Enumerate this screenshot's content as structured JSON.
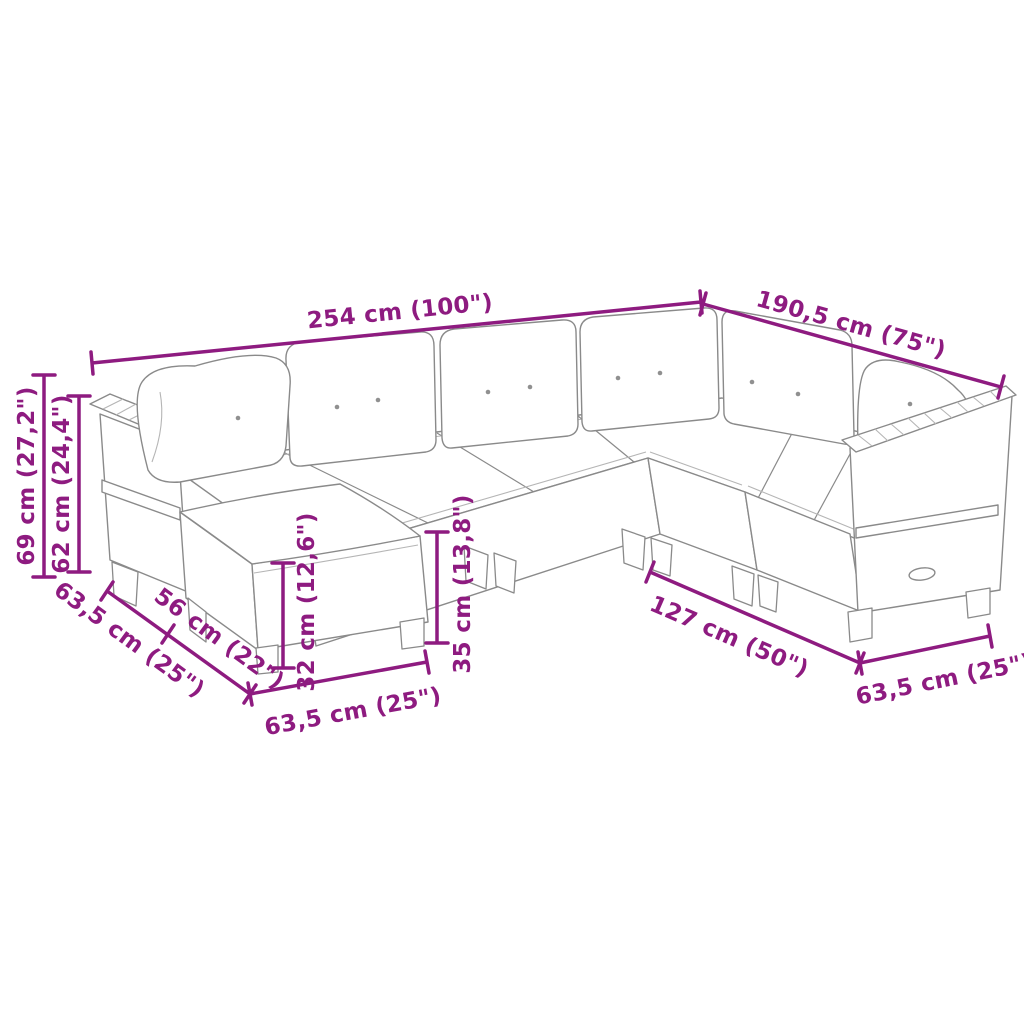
{
  "page": {
    "background": "#ffffff",
    "description_visible_text_only": true
  },
  "colors": {
    "dimension_accent": "#8E1B80",
    "line_art": "#8a8a8a",
    "rattan_texture": "#ababab",
    "cushion_fill": "#ffffff"
  },
  "dimensions": {
    "total_length_top": {
      "label": "254 cm (100\")"
    },
    "total_depth_right": {
      "label": "190,5 cm (75\")"
    },
    "overall_height": {
      "label": "69 cm (27,2\")"
    },
    "armrest_height": {
      "label": "62 cm (24,4\")"
    },
    "module_depth_left": {
      "label": "63,5 cm (25\")"
    },
    "seat_width": {
      "label": "56 cm (22\")"
    },
    "footstool_height": {
      "label": "32 cm (12,6\")"
    },
    "seat_height": {
      "label": "35 cm (13,8\")"
    },
    "footstool_width": {
      "label": "63,5 cm (25\")"
    },
    "right_section_length": {
      "label": "127 cm (50\")"
    },
    "end_module_depth": {
      "label": "63,5 cm (25\")"
    }
  }
}
